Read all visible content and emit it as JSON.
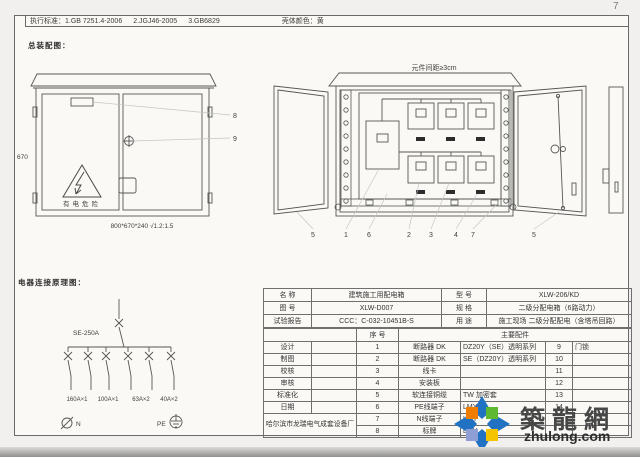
{
  "page": {
    "number": "7"
  },
  "standards_bar": {
    "label": "执行标准：",
    "items": [
      "1.GB 7251.4-2006",
      "2.JGJ46-2005",
      "3.GB6829"
    ],
    "shell_color_label": "壳体颜色：",
    "shell_color": "黄"
  },
  "sections": {
    "assembly": "总装配图：",
    "schematic": "电器连接原理图："
  },
  "front_view": {
    "height_dim": "670",
    "size_spec": "800*670*240 √1.2:1.5",
    "warning": "有电危险",
    "callout_plate": "8",
    "callout_lock": "9"
  },
  "open_view": {
    "note": "元件间距≥3cm",
    "callouts": [
      "5",
      "1",
      "6",
      "2",
      "3",
      "4",
      "7",
      "5"
    ]
  },
  "schematic": {
    "main_breaker": "SE-250A",
    "branches": [
      "160A×1",
      "100A×1",
      "63A×2",
      "40A×2"
    ],
    "neutral": "N",
    "pe": "PE"
  },
  "title_block": {
    "info": [
      {
        "l": "名  称",
        "v": "建筑施工用配电箱",
        "l2": "型  号",
        "v2": "XLW-206/KD"
      },
      {
        "l": "图  号",
        "v": "XLW-D007",
        "l2": "规  格",
        "v2": "二级分配电箱（6路动力）"
      },
      {
        "l": "试验报告",
        "v": "CCC：C-032-10451B-S",
        "l2": "用  途",
        "v2": "施工现场 二级分配配电（含塔吊回路）"
      }
    ],
    "subheader": {
      "seq": "序  号",
      "parts": "主要配件"
    },
    "rows": [
      {
        "s": "设计",
        "n": "1",
        "p": "断路器 DK",
        "sp": "DZ20Y（SE）透明系列",
        "n2": "9",
        "p2": "门锁"
      },
      {
        "s": "制图",
        "n": "2",
        "p": "断路器 DK",
        "sp": "SE（DZ20Y）透明系列",
        "n2": "10",
        "p2": ""
      },
      {
        "s": "校核",
        "n": "3",
        "p": "线卡",
        "sp": "",
        "n2": "11",
        "p2": ""
      },
      {
        "s": "审核",
        "n": "4",
        "p": "安装板",
        "sp": "",
        "n2": "12",
        "p2": ""
      },
      {
        "s": "标准化",
        "n": "5",
        "p": "软连接铜缆",
        "sp": "TW 加密套",
        "n2": "13",
        "p2": ""
      },
      {
        "s": "日期",
        "n": "6",
        "p": "PE线端子",
        "sp": "LMY",
        "n2": "14",
        "p2": ""
      },
      {
        "n": "7",
        "p": "N线端子",
        "sp": "LMY",
        "n2": "",
        "p2": ""
      },
      {
        "n": "8",
        "p": "标牌",
        "sp": "LMY",
        "n2": "",
        "p2": ""
      }
    ],
    "company": "哈尔滨市龙瑞电气成套设备厂"
  },
  "watermark": {
    "title": "築龍網",
    "url": "zhulong.com"
  }
}
